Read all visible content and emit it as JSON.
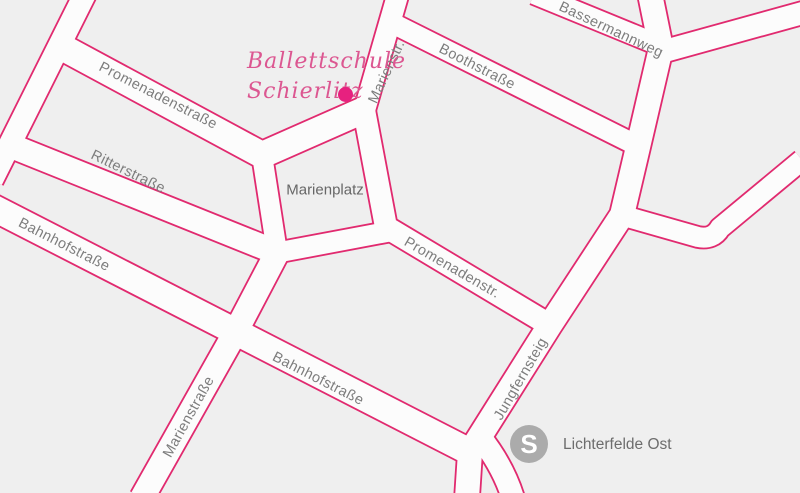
{
  "map": {
    "colors": {
      "background": "#efefef",
      "street_fill": "#fcfcfc",
      "street_casing": "#e12a6f",
      "street_label": "#7d7d7d",
      "place_label": "#676767",
      "marker_text": "#dc5791",
      "marker_dot": "#e7217f",
      "station_circle": "#ababab",
      "station_label": "#6d6d6d"
    },
    "streets": [
      {
        "name": "street-top-left-steep",
        "d": "M 85,-6 L -8,180",
        "w": 22
      },
      {
        "name": "promenadenstrasse",
        "d": "M 58,45 L 262,155 L 364,110",
        "w": 26
      },
      {
        "name": "ritterstrasse",
        "d": "M 4,143 L 278,253",
        "w": 24
      },
      {
        "name": "bahnhofstrasse",
        "d": "M -8,207 L 472,453",
        "w": 26
      },
      {
        "name": "marienstrasse",
        "d": "M 278,251 L 235,333 L 142,498",
        "w": 24
      },
      {
        "name": "marienplatz-west-street",
        "d": "M 262,155 L 277,252",
        "w": 20
      },
      {
        "name": "marienplatz-south-street",
        "d": "M 275,253 L 392,231",
        "w": 20
      },
      {
        "name": "promenadenstr-diagonal",
        "d": "M 364,110 L 386,227 L 558,330",
        "w": 22
      },
      {
        "name": "marienstr-north",
        "d": "M 398,-6 L 364,112",
        "w": 21
      },
      {
        "name": "boothstrasse",
        "d": "M 390,22 L 644,149",
        "w": 20
      },
      {
        "name": "bassermannweg",
        "d": "M 534,-6 L 661,46",
        "w": 20
      },
      {
        "name": "jungfernsteig",
        "d": "M 650,-6 L 661,48 L 638,147 L 622,215 L 550,325 L 470,452 L 467,498",
        "w": 24
      },
      {
        "name": "street-top-right-corner",
        "d": "M 654,54 L 806,12",
        "w": 22
      },
      {
        "name": "street-right-bend",
        "d": "M 624,216 L 698,237 Q 713,240 720,228 L 802,160",
        "w": 20
      },
      {
        "name": "south-exit-curve",
        "d": "M 480,437 Q 503,466 513,498",
        "w": 22
      }
    ],
    "street_labels": [
      {
        "text": "Promenadenstraße",
        "x": 158,
        "y": 96,
        "rot": 27
      },
      {
        "text": "Ritterstraße",
        "x": 128,
        "y": 172,
        "rot": 26
      },
      {
        "text": "Bahnhofstraße",
        "x": 64,
        "y": 245,
        "rot": 27
      },
      {
        "text": "Bahnhofstraße",
        "x": 318,
        "y": 379,
        "rot": 27
      },
      {
        "text": "Marienstraße",
        "x": 189,
        "y": 417,
        "rot": -61
      },
      {
        "text": "Marienstr.",
        "x": 387,
        "y": 72,
        "rot": -65
      },
      {
        "text": "Boothstraße",
        "x": 477,
        "y": 67,
        "rot": 27
      },
      {
        "text": "Bassermannweg",
        "x": 611,
        "y": 30,
        "rot": 25
      },
      {
        "text": "Jungfernsteig",
        "x": 521,
        "y": 379,
        "rot": -60
      },
      {
        "text": "Promenadenstr.",
        "x": 452,
        "y": 268,
        "rot": 30
      }
    ],
    "place": {
      "text": "Marienplatz"
    },
    "marker": {
      "line1": "Ballettschule",
      "line2": "Schierlitz"
    },
    "station": {
      "symbol": "S",
      "label": "Lichterfelde Ost"
    }
  }
}
